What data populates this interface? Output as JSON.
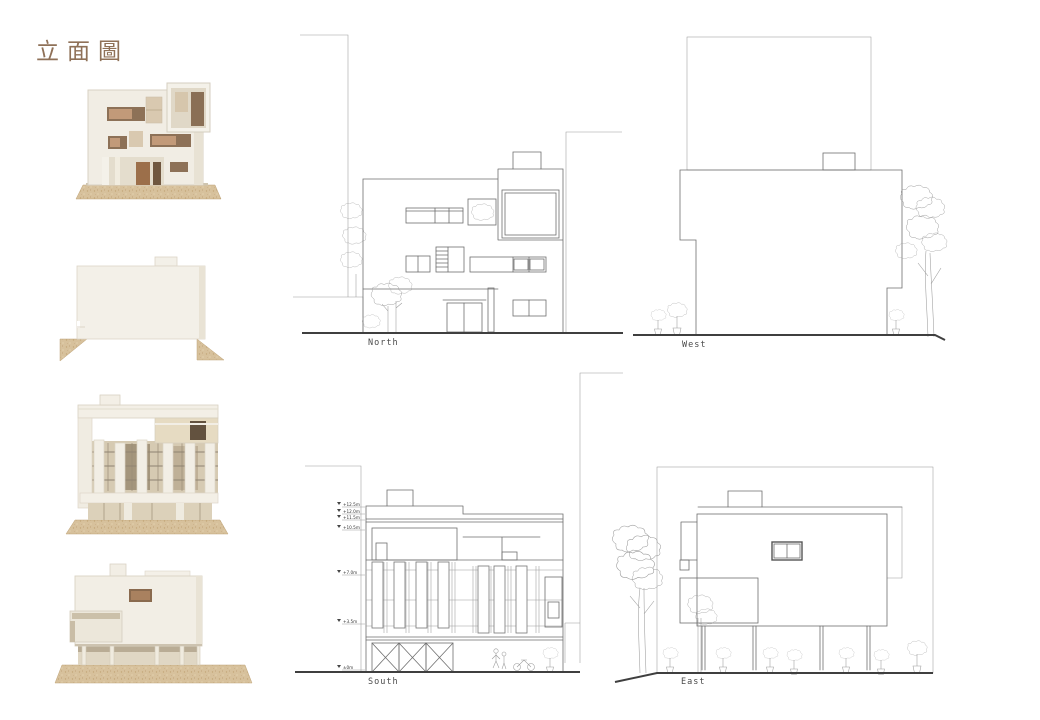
{
  "page": {
    "title": "立面圖",
    "title_color": "#8f7158",
    "background": "#ffffff"
  },
  "elevations": {
    "north": {
      "label": "North"
    },
    "west": {
      "label": "West"
    },
    "south": {
      "label": "South",
      "level_markers": [
        "+12.5m",
        "+12.0m",
        "+11.5m",
        "+10.5m",
        "+7.0m",
        "+3.5m",
        "±0m"
      ]
    },
    "east": {
      "label": "East"
    }
  }
}
